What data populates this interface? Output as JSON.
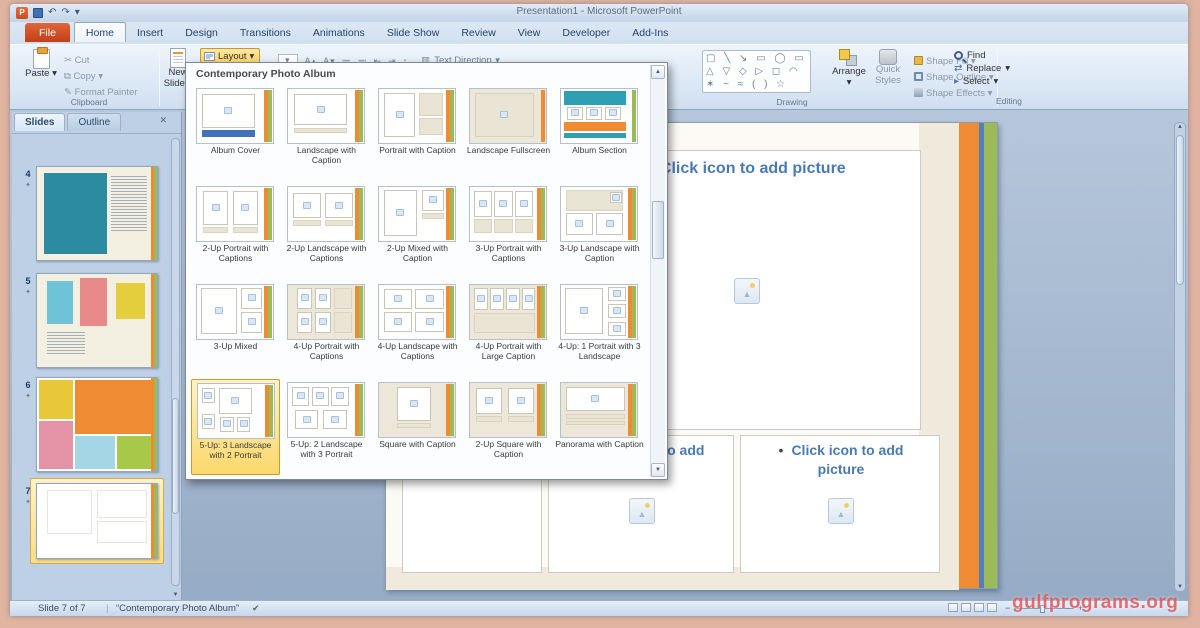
{
  "window": {
    "title": "Presentation1 - Microsoft PowerPoint"
  },
  "tabs": [
    {
      "label": "File",
      "file": true
    },
    {
      "label": "Home",
      "active": true
    },
    {
      "label": "Insert"
    },
    {
      "label": "Design"
    },
    {
      "label": "Transitions"
    },
    {
      "label": "Animations"
    },
    {
      "label": "Slide Show"
    },
    {
      "label": "Review"
    },
    {
      "label": "View"
    },
    {
      "label": "Developer"
    },
    {
      "label": "Add-Ins"
    }
  ],
  "ribbon": {
    "clipboard": {
      "paste": "Paste",
      "cut": "Cut",
      "copy": "Copy",
      "format_painter": "Format Painter",
      "group_label": "Clipboard"
    },
    "slides_group": {
      "new_slide_line1": "New",
      "new_slide_line2": "Slide",
      "layout": "Layout"
    },
    "mini_controls": [
      {
        "name": "grow-font-icon",
        "glyph": "A▴"
      },
      {
        "name": "shrink-font-icon",
        "glyph": "A▾"
      },
      {
        "name": "bullets-icon",
        "glyph": "≔"
      },
      {
        "name": "numbering-icon",
        "glyph": "≕"
      },
      {
        "name": "indent-less-icon",
        "glyph": "⇤"
      },
      {
        "name": "indent-more-icon",
        "glyph": "⇥"
      },
      {
        "name": "line-spacing-icon",
        "glyph": "↕"
      }
    ],
    "text_direction": "Text Direction",
    "drawing": {
      "shapes_rows": [
        "▢ ╲ ↘ ▭ ◯ ▭",
        "△ ▽ ◇ ▷ ◻ ◠",
        "✶ ~ ≈ ( ) ☆"
      ],
      "arrange": "Arrange",
      "quick_styles": "Quick Styles",
      "shape_fill": "Shape Fill",
      "shape_outline": "Shape Outline",
      "shape_effects": "Shape Effects",
      "group_label": "Drawing"
    },
    "editing": {
      "find": "Find",
      "replace": "Replace",
      "select": "Select",
      "group_label": "Editing"
    }
  },
  "slides_panel": {
    "tabs": [
      {
        "label": "Slides",
        "active": true
      },
      {
        "label": "Outline"
      }
    ],
    "thumbnails": [
      {
        "number": "4",
        "top": 32,
        "h": 95,
        "art": {
          "bg": "#f4f0e1",
          "blocks": [
            [
              6,
              6,
              52,
              88,
              "#2d8ba1"
            ]
          ],
          "tlines": [
            62,
            10,
            30,
            60
          ]
        }
      },
      {
        "number": "5",
        "top": 139,
        "h": 95,
        "art": {
          "bg": "#f4f0e1",
          "blocks": [
            [
              8,
              8,
              22,
              46,
              "#6fc3d6"
            ],
            [
              36,
              4,
              22,
              52,
              "#e98a8a"
            ],
            [
              66,
              10,
              24,
              38,
              "#e5ce3e"
            ]
          ],
          "tlines": [
            8,
            62,
            32,
            24
          ]
        }
      },
      {
        "number": "6",
        "top": 243,
        "h": 95,
        "art": {
          "bg": "#ffffff",
          "blocks": [
            [
              2,
              2,
              28,
              42,
              "#e8c838"
            ],
            [
              32,
              2,
              66,
              58,
              "#ef8b33"
            ],
            [
              2,
              46,
              28,
              52,
              "#e494a6"
            ],
            [
              32,
              62,
              33,
              36,
              "#a5d6e6"
            ],
            [
              67,
              62,
              31,
              36,
              "#a8c84a"
            ]
          ]
        }
      },
      {
        "number": "7",
        "top": 349,
        "h": 76,
        "selected": true,
        "art": {
          "bg": "#ffffff",
          "faint": true
        }
      }
    ]
  },
  "layout_gallery": {
    "title": "Contemporary Photo Album",
    "items": [
      {
        "label": "Album Cover",
        "bg": "w",
        "boxes": [
          [
            6,
            10,
            70,
            62
          ]
        ],
        "bands": [
          [
            6,
            76,
            70,
            13,
            "#3f72b8"
          ]
        ],
        "stripes": [
          "#ef8b33",
          "#9bbb59"
        ]
      },
      {
        "label": "Landscape with Caption",
        "bg": "w",
        "boxes": [
          [
            8,
            10,
            70,
            56
          ]
        ],
        "cream": [
          [
            8,
            72,
            70,
            9
          ]
        ]
      },
      {
        "label": "Portrait with Caption",
        "bg": "w",
        "boxes": [
          [
            6,
            8,
            42,
            80
          ]
        ],
        "cream": [
          [
            52,
            8,
            32,
            42
          ],
          [
            52,
            54,
            32,
            32
          ]
        ]
      },
      {
        "label": "Landscape Fullscreen",
        "bg": "c",
        "boxes": [
          [
            6,
            8,
            78,
            80,
            "c"
          ]
        ],
        "stripes": [
          "#ef8b33"
        ]
      },
      {
        "label": "Album Section",
        "bg": "w",
        "bands": [
          [
            4,
            4,
            82,
            26,
            "#2f9fb3"
          ],
          [
            4,
            62,
            82,
            16,
            "#ef8b33"
          ],
          [
            4,
            82,
            82,
            8,
            "#2f9fb3"
          ]
        ],
        "boxes": [
          [
            8,
            33,
            21,
            24
          ],
          [
            33,
            33,
            21,
            24
          ],
          [
            58,
            33,
            21,
            24
          ]
        ],
        "stripes": [
          "#9bbb59"
        ]
      },
      {
        "label": "2-Up Portrait with Captions",
        "bg": "w",
        "boxes": [
          [
            8,
            8,
            33,
            62
          ],
          [
            47,
            8,
            33,
            62
          ]
        ],
        "cream": [
          [
            8,
            74,
            33,
            12
          ],
          [
            47,
            74,
            33,
            12
          ]
        ]
      },
      {
        "label": "2-Up Landscape with Captions",
        "bg": "w",
        "boxes": [
          [
            6,
            12,
            37,
            46
          ],
          [
            49,
            12,
            37,
            46
          ]
        ],
        "cream": [
          [
            6,
            62,
            37,
            10
          ],
          [
            49,
            62,
            37,
            10
          ]
        ]
      },
      {
        "label": "2-Up Mixed with Caption",
        "bg": "w",
        "boxes": [
          [
            6,
            6,
            44,
            84
          ],
          [
            56,
            6,
            30,
            38
          ]
        ],
        "cream": [
          [
            56,
            48,
            30,
            12
          ]
        ]
      },
      {
        "label": "3-Up Portrait with Captions",
        "bg": "w",
        "boxes": [
          [
            5,
            8,
            24,
            48
          ],
          [
            32,
            8,
            24,
            48
          ],
          [
            59,
            8,
            24,
            48
          ]
        ],
        "cream": [
          [
            5,
            60,
            24,
            26
          ],
          [
            32,
            60,
            24,
            26
          ],
          [
            59,
            60,
            24,
            26
          ]
        ]
      },
      {
        "label": "3-Up Landscape with Caption",
        "bg": "w",
        "cream": [
          [
            6,
            6,
            76,
            38
          ]
        ],
        "boxes": [
          [
            64,
            10,
            16,
            20
          ],
          [
            6,
            48,
            36,
            40
          ],
          [
            46,
            48,
            36,
            40
          ]
        ]
      },
      {
        "label": "3-Up Mixed",
        "bg": "w",
        "boxes": [
          [
            5,
            6,
            48,
            84
          ],
          [
            58,
            6,
            28,
            38
          ],
          [
            58,
            50,
            28,
            38
          ]
        ]
      },
      {
        "label": "4-Up Portrait with Captions",
        "bg": "c",
        "boxes": [
          [
            12,
            6,
            20,
            38
          ],
          [
            36,
            6,
            20,
            38
          ],
          [
            12,
            50,
            20,
            38
          ],
          [
            36,
            50,
            20,
            38
          ]
        ],
        "cream": [
          [
            60,
            6,
            24,
            38
          ],
          [
            60,
            50,
            24,
            38
          ]
        ]
      },
      {
        "label": "4-Up Landscape with Captions",
        "bg": "w",
        "boxes": [
          [
            7,
            8,
            37,
            37
          ],
          [
            48,
            8,
            37,
            37
          ],
          [
            7,
            50,
            37,
            37
          ],
          [
            48,
            50,
            37,
            37
          ]
        ]
      },
      {
        "label": "4-Up Portrait with Large Caption",
        "bg": "c",
        "boxes": [
          [
            5,
            6,
            19,
            40
          ],
          [
            26,
            6,
            19,
            40
          ],
          [
            47,
            6,
            19,
            40
          ],
          [
            68,
            6,
            18,
            40
          ]
        ],
        "cream": [
          [
            5,
            52,
            81,
            36
          ]
        ]
      },
      {
        "label": "4-Up: 1 Portrait with 3 Landscape",
        "bg": "w",
        "boxes": [
          [
            5,
            6,
            50,
            84
          ],
          [
            62,
            4,
            24,
            26
          ],
          [
            62,
            36,
            24,
            26
          ],
          [
            62,
            68,
            24,
            26
          ]
        ]
      },
      {
        "label": "5-Up: 3 Landscape with 2 Portrait",
        "selected": true,
        "bg": "w",
        "boxes": [
          [
            5,
            8,
            17,
            28
          ],
          [
            5,
            56,
            17,
            28
          ],
          [
            27,
            8,
            44,
            48
          ],
          [
            29,
            62,
            18,
            26
          ],
          [
            51,
            62,
            18,
            26
          ]
        ]
      },
      {
        "label": "5-Up: 2 Landscape with 3 Portrait",
        "bg": "w",
        "boxes": [
          [
            5,
            8,
            23,
            34
          ],
          [
            31,
            8,
            23,
            34
          ],
          [
            57,
            8,
            23,
            34
          ],
          [
            9,
            50,
            31,
            36
          ],
          [
            46,
            50,
            31,
            36
          ]
        ]
      },
      {
        "label": "Square with Caption",
        "bg": "c",
        "boxes": [
          [
            24,
            8,
            44,
            62
          ]
        ],
        "cream": [
          [
            24,
            74,
            44,
            10
          ]
        ]
      },
      {
        "label": "2-Up Square with Caption",
        "bg": "c",
        "boxes": [
          [
            8,
            10,
            34,
            48
          ],
          [
            50,
            10,
            34,
            48
          ]
        ],
        "cream": [
          [
            8,
            62,
            34,
            10
          ],
          [
            50,
            62,
            34,
            10
          ]
        ]
      },
      {
        "label": "Panorama with Caption",
        "bg": "c",
        "boxes": [
          [
            6,
            8,
            78,
            44
          ]
        ],
        "cream": [
          [
            6,
            58,
            78,
            8
          ],
          [
            6,
            70,
            78,
            8
          ]
        ]
      }
    ]
  },
  "slide_canvas": {
    "top_placeholder": {
      "bullet": "•",
      "label": "Click icon to add picture"
    },
    "bottom_middle": {
      "bullet": "•",
      "label": "Click icon to add picture"
    },
    "bottom_right": {
      "bullet": "•",
      "label": "Click icon to add picture"
    }
  },
  "status_bar": {
    "slide_indicator": "Slide 7 of 7",
    "theme_name": "“Contemporary Photo Album”"
  },
  "watermark": "gulfprograms.org",
  "colors": {
    "accent_orange": "#ef8b33",
    "accent_green": "#9bbb59",
    "accent_blue": "#4f81bd",
    "accent_teal": "#2f9fb3",
    "selection_yellow": "#fbd96d",
    "file_tab_red": "#cf4a2a"
  }
}
